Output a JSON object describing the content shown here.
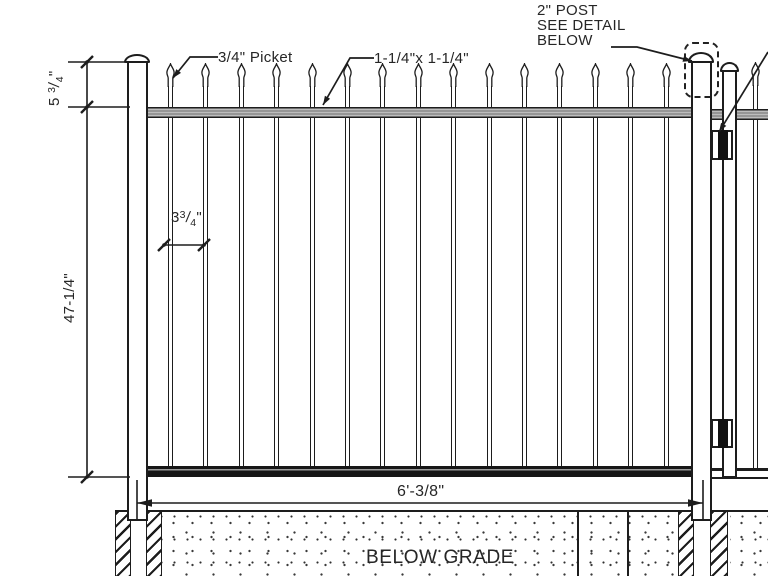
{
  "annotations": {
    "picket": {
      "label": "3/4\" Picket"
    },
    "rail": {
      "label": "1-1/4\"x 1-1/4\""
    },
    "post": {
      "line1": "2\" POST",
      "line2": "SEE DETAIL",
      "line3": "BELOW"
    }
  },
  "dimensions": {
    "post_exposure": {
      "whole": "5",
      "num": "3",
      "slash": "/",
      "den": "4",
      "unit": "\""
    },
    "fence_height": {
      "label": "47-1/4\""
    },
    "picket_spacing": {
      "whole": "3",
      "num": "3",
      "slash": "/",
      "den": "4",
      "unit": "\""
    },
    "panel_width": {
      "label": "6'-3/8\""
    }
  },
  "grade": {
    "label": "BELOW GRADE"
  },
  "colors": {
    "line": "#1d1d1d",
    "rail_gray": "#bdbdbd",
    "rail_dark": "#161616",
    "background": "#ffffff"
  }
}
